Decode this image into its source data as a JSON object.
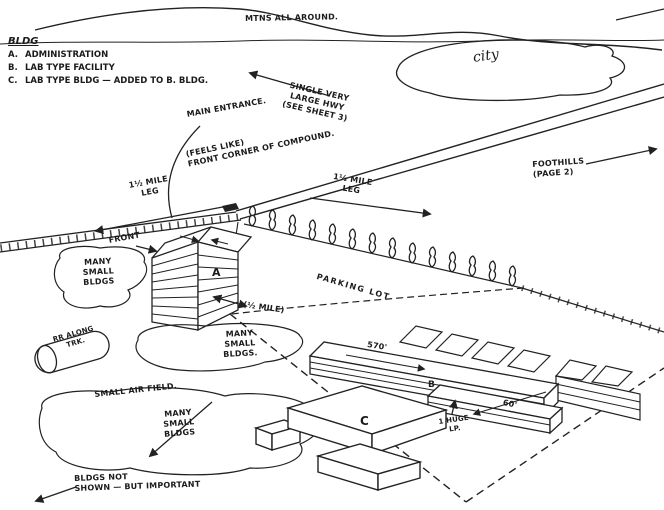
{
  "palette": {
    "ink": "#222222",
    "paper": "#ffffff"
  },
  "legend": {
    "heading": "BLDG",
    "items": [
      {
        "key": "A.",
        "name": "ADMINISTRATION"
      },
      {
        "key": "B.",
        "name": "LAB TYPE FACILITY"
      },
      {
        "key": "C.",
        "name": "LAB TYPE BLDG — ADDED TO B. BLDG."
      }
    ]
  },
  "labels": {
    "mountains": "MTNS ALL AROUND.",
    "city": "city",
    "highway": "SINGLE VERY\nLARGE HWY\n(SEE SHEET 3)",
    "main_entrance": "MAIN ENTRANCE.",
    "front_corner": "(FEELS LIKE)\nFRONT CORNER OF COMPOUND.",
    "left_leg": "1½ MILE\nLEG",
    "right_leg": "1½ MILE\nLEG",
    "foothills": "FOOTHILLS\n(PAGE 2)",
    "front": "FRONT",
    "building_a": "A",
    "building_b": "B",
    "building_c": "C",
    "many_small_bldgs_left": "MANY\nSMALL\nBLDGS",
    "rr_tank": "RR ALONG\nTRK.",
    "many_small_bldgs_center": "MANY\nSMALL\nBLDGS.",
    "parking_lot": "PARKING LOT",
    "half_mile": "(½ MILE)",
    "length_570": "570'",
    "width_60": "60'",
    "huge_lp": "1 HUGE\nLP.",
    "small_airfield": "SMALL AIR FIELD.",
    "many_small_bldgs_bottom": "MANY\nSMALL\nBLDGS",
    "bldgs_not_shown": "BLDGS NOT\nSHOWN — BUT IMPORTANT"
  }
}
